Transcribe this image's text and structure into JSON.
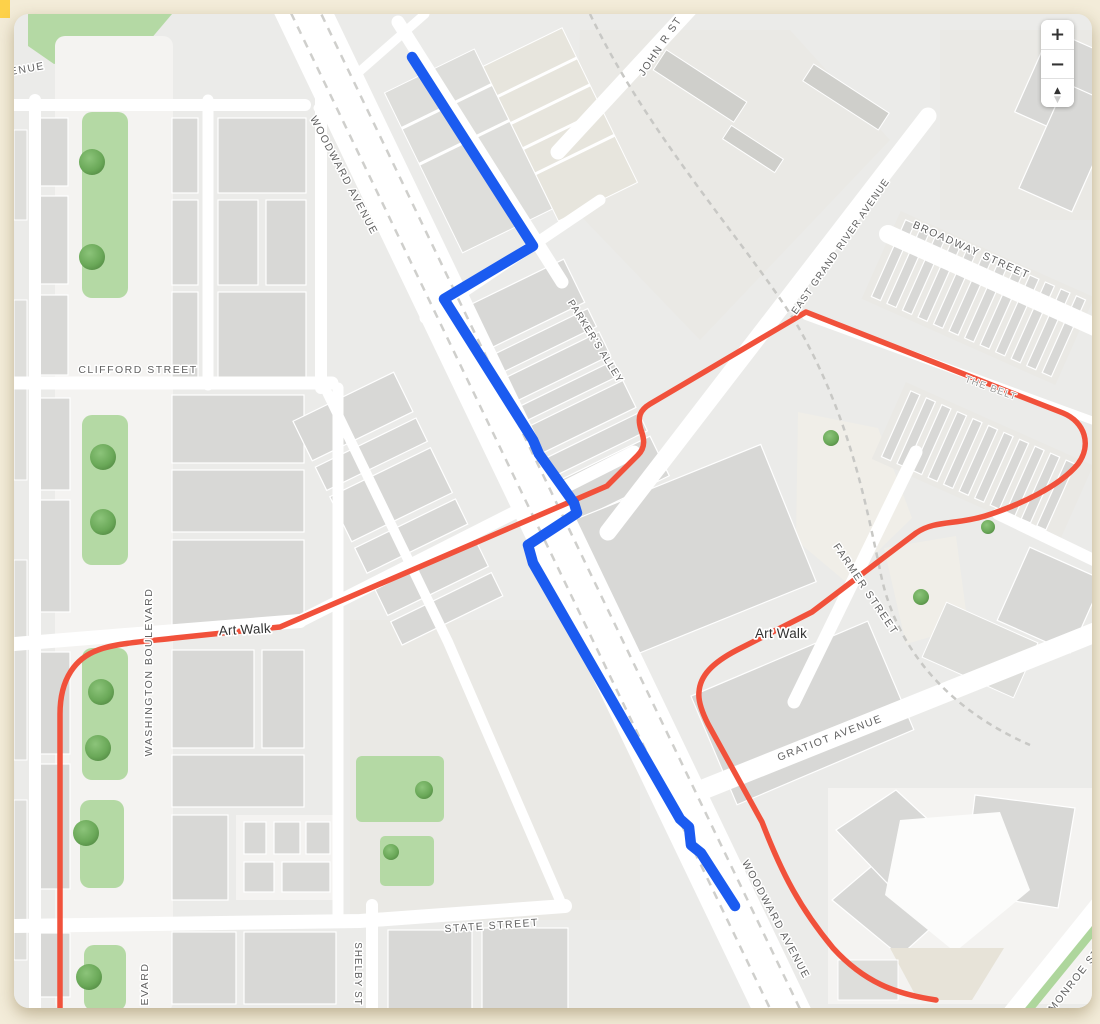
{
  "page": {
    "background": "#f3ecd9",
    "corner_accent": "#fdd14a"
  },
  "map": {
    "colors": {
      "background": "#ebebe9",
      "route_blue": "#1b5bf0",
      "route_red": "#f1513b",
      "building": "#d8d8d6",
      "road": "#ffffff",
      "green": "#b4d9a4"
    },
    "controls": {
      "zoom_in": "+",
      "zoom_out": "−",
      "pitch_up": "▲",
      "pitch_down": "▼"
    },
    "labels": {
      "avenue_partial": "ENUE",
      "john_r_street": "JOHN R ST",
      "woodward_avenue_north": "WOODWARD AVENUE",
      "parkers_alley": "PARKER'S ALLEY",
      "east_grand_river_avenue": "EAST GRAND RIVER AVENUE",
      "broadway_street": "BROADWAY STREET",
      "clifford_street": "CLIFFORD STREET",
      "the_belt": "THE BELT",
      "art_walk_west": "Art Walk",
      "art_walk_east": "Art Walk",
      "washington_boulevard": "WASHINGTON BOULEVARD",
      "farmer_street": "FARMER STREET",
      "gratiot_avenue": "GRATIOT AVENUE",
      "state_street": "STATE STREET",
      "shelby_street": "SHELBY ST",
      "woodward_avenue_south": "WOODWARD AVENUE",
      "monroe_street": "MONROE ST",
      "boulevard_partial": "EVARD"
    }
  }
}
